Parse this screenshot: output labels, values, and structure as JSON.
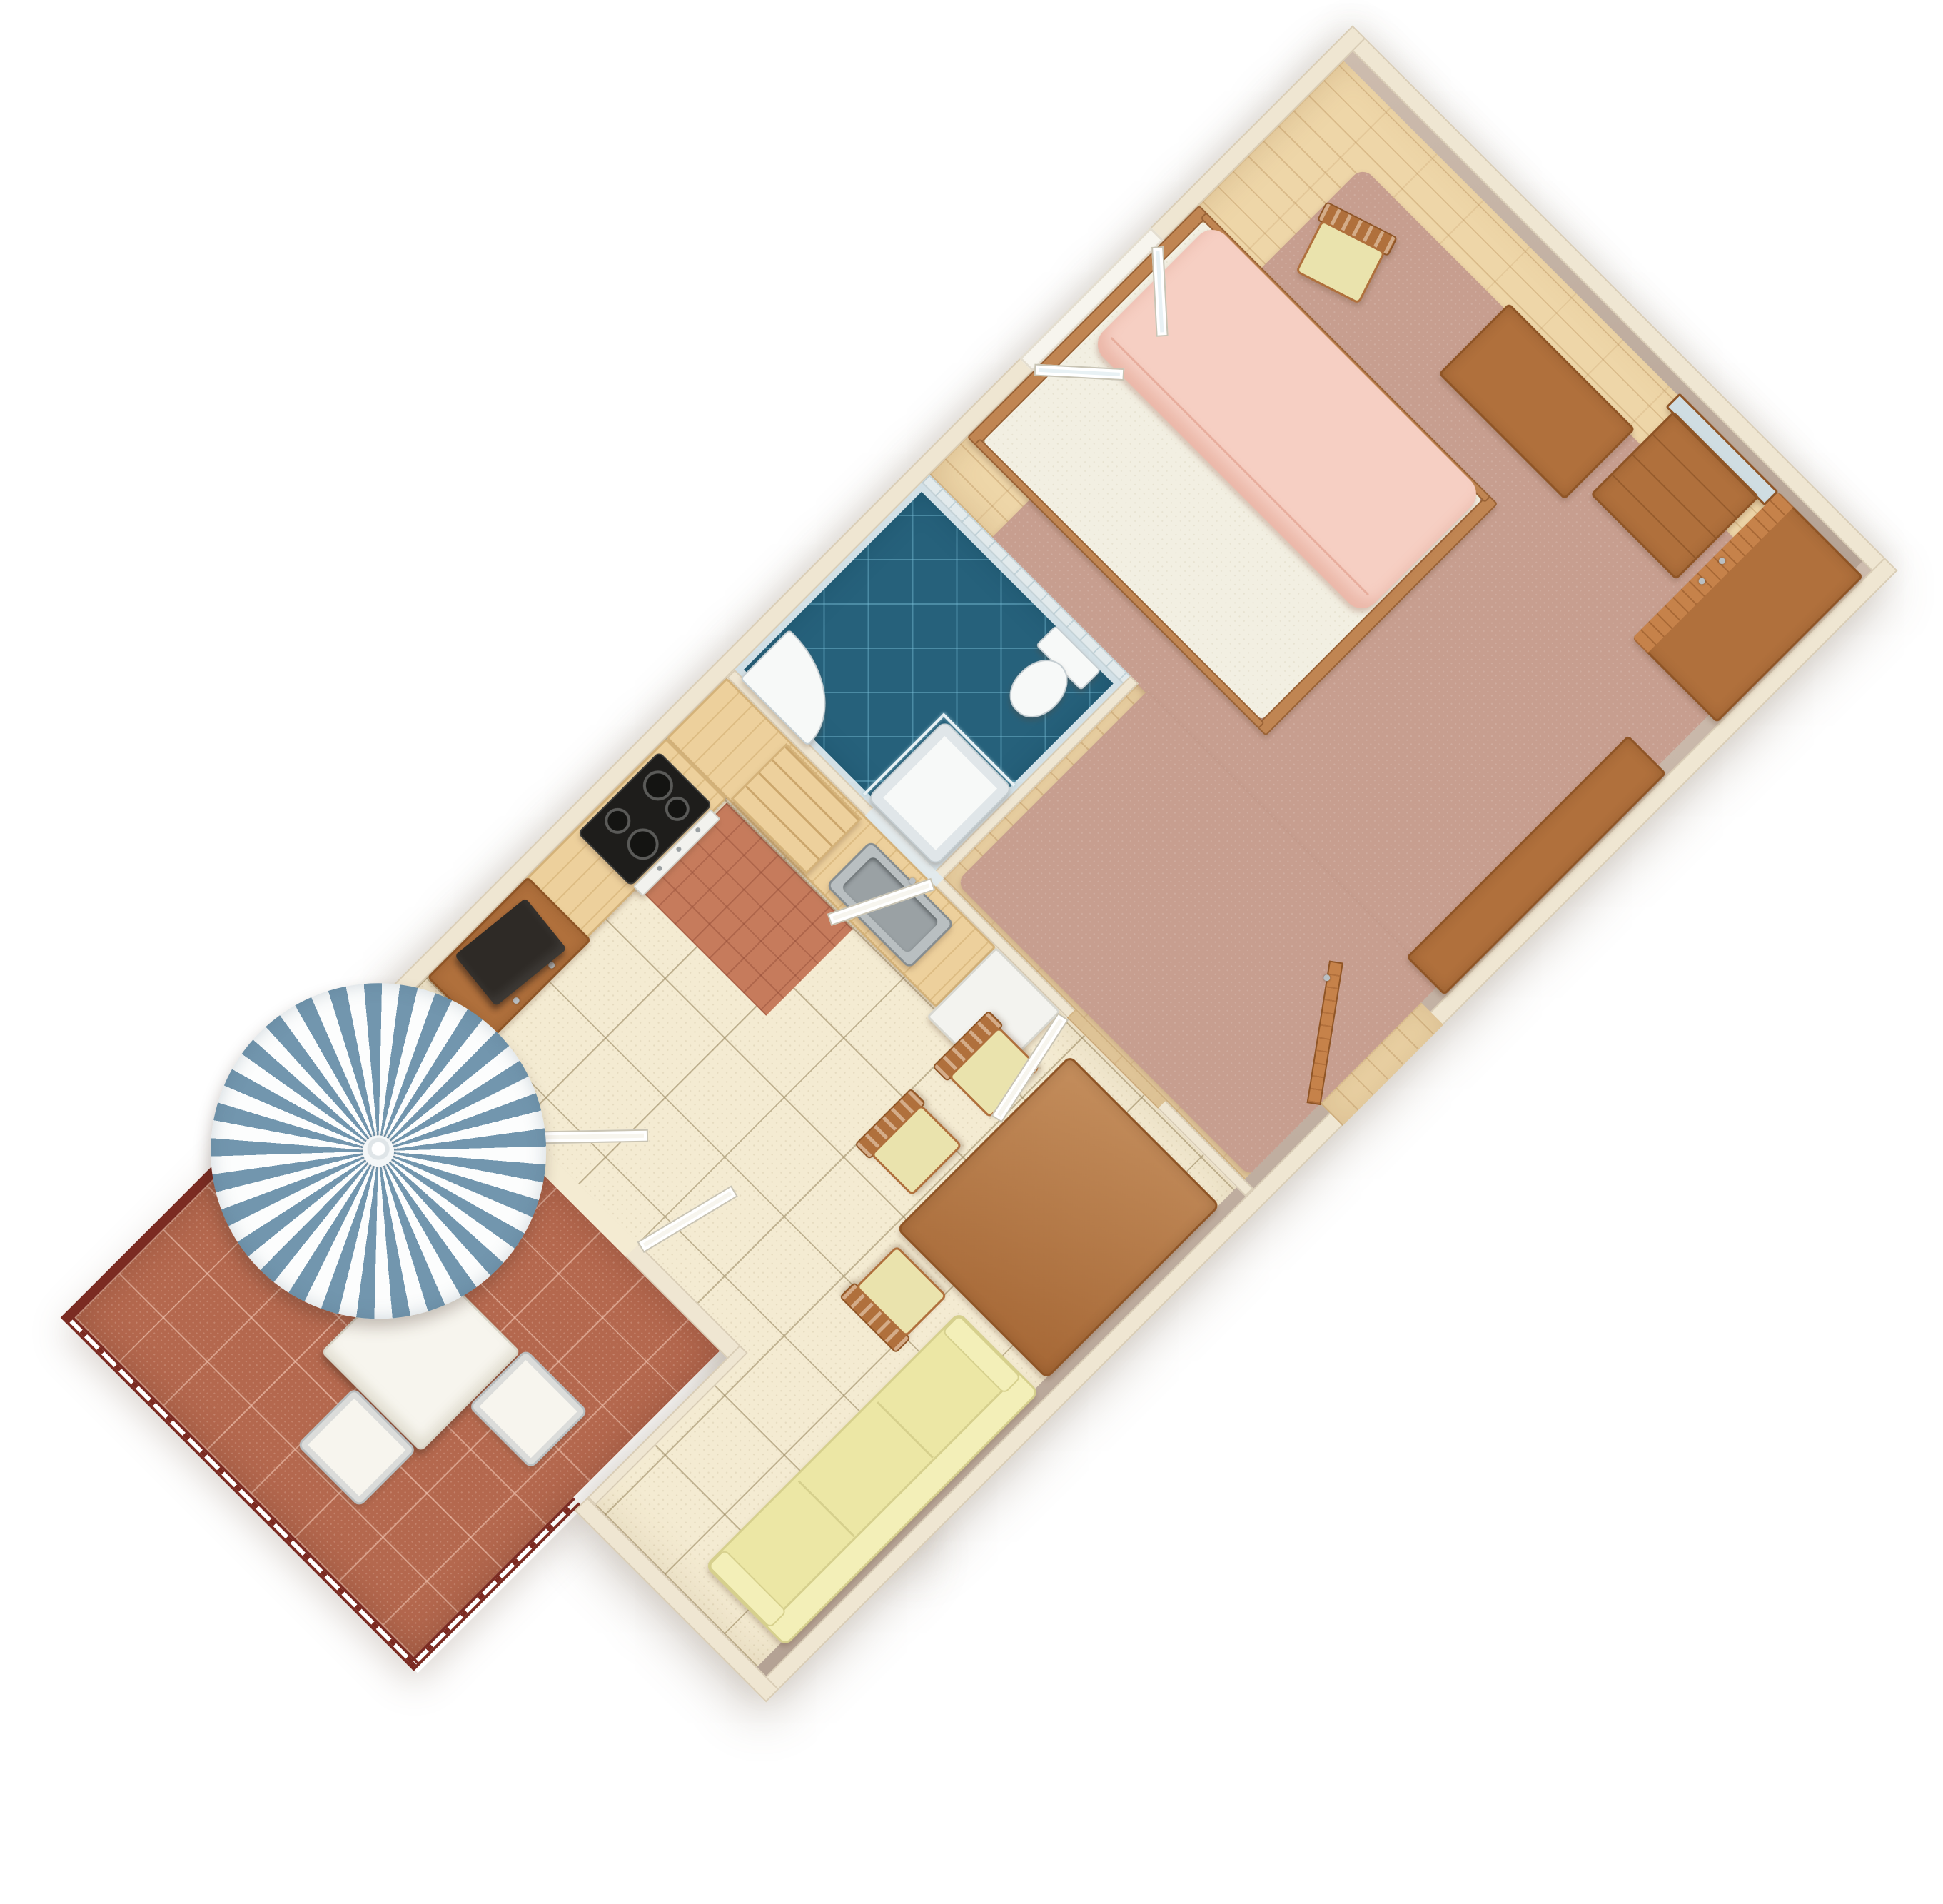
{
  "scene": {
    "type": "3d-floorplan-rendering",
    "subject": "one-bedroom apartment with bathroom, kitchen, living-dining room and balcony",
    "view": "top-down axonometric, plan rotated 45 degrees on white background",
    "rotation_deg": 45,
    "background_color": "#ffffff"
  },
  "colors": {
    "pageBg": "#ffffff",
    "wall": "#efe6d2",
    "wallEdge": "#d9cdb6",
    "wallFace": "#b4a294",
    "wallFaceLight": "#cdbcae",
    "bathWall": "#e2eaec",
    "parquet": "#eed6a8",
    "carpet": "#c79e8f",
    "livingFloor": "#f4ebd2",
    "bathFloor": "#26617b",
    "terracotta": "#b4684e",
    "patchTile": "#c67b5c",
    "railing": "#7b2b22",
    "umbrellaBlue": "#7296ae",
    "umbrellaWhite": "#fcfdfd",
    "wood": "#b0703c",
    "woodDark": "#8f5526",
    "woodLight": "#c6824a",
    "kitchenWood": "#edd09c",
    "kitchenEdge": "#d4b279",
    "steel": "#b9bfc1",
    "steelDark": "#868d90",
    "cooktop": "#1e1d1b",
    "sofa": "#ece7a5",
    "sofaEdge": "#d6d08d",
    "seat": "#eae3ad",
    "mattress": "#f2efe2",
    "blanket": "#f6cfc3",
    "bedFrame": "#c08552",
    "fixture": "#f7f9f8",
    "fixtureEdge": "#c5ced2",
    "glass": "#e8f1f4",
    "doorWhite": "#f7f5ee",
    "fridge": "#f3f3ef",
    "mirror": "#cfdde2",
    "tv": "#2e2a26"
  },
  "apartment": {
    "rooms": [
      {
        "name": "bedroom",
        "floor": "light parquet with rose carpet",
        "furniture": [
          "double-bed",
          "side-chair",
          "desk",
          "vanity-with-mirror",
          "wardrobe",
          "sideboard",
          "casement-window"
        ]
      },
      {
        "name": "bathroom",
        "floor": "dark blue diagonal tile with white tiled walls",
        "furniture": [
          "toilet",
          "shower-tray",
          "glass-partition",
          "washbasin"
        ]
      },
      {
        "name": "kitchen",
        "floor": "cream tile with terracotta corner patch",
        "furniture": [
          "l-shaped-counter",
          "corner-shelves",
          "cooktop-with-oven",
          "sink",
          "refrigerator"
        ]
      },
      {
        "name": "living-dining",
        "floor": "cream speckled tile",
        "furniture": [
          "dining-table",
          "dining-chair x3",
          "sofa",
          "tv-stand",
          "tv"
        ]
      },
      {
        "name": "balcony",
        "floor": "terracotta tile",
        "furniture": [
          "parasol",
          "patio-table",
          "patio-chair x2",
          "railing"
        ]
      }
    ],
    "doors": [
      "entry-door (wood, open)",
      "bedroom-living door (open)",
      "bathroom door (open)",
      "balcony double door (both leaves open)"
    ],
    "counts": {
      "rooms": 5,
      "dining_chairs": 3,
      "patio_chairs": 2,
      "sofa_cushions": 3,
      "cooktop_burners": 4,
      "umbrella_stripe_pairs": 29
    }
  }
}
